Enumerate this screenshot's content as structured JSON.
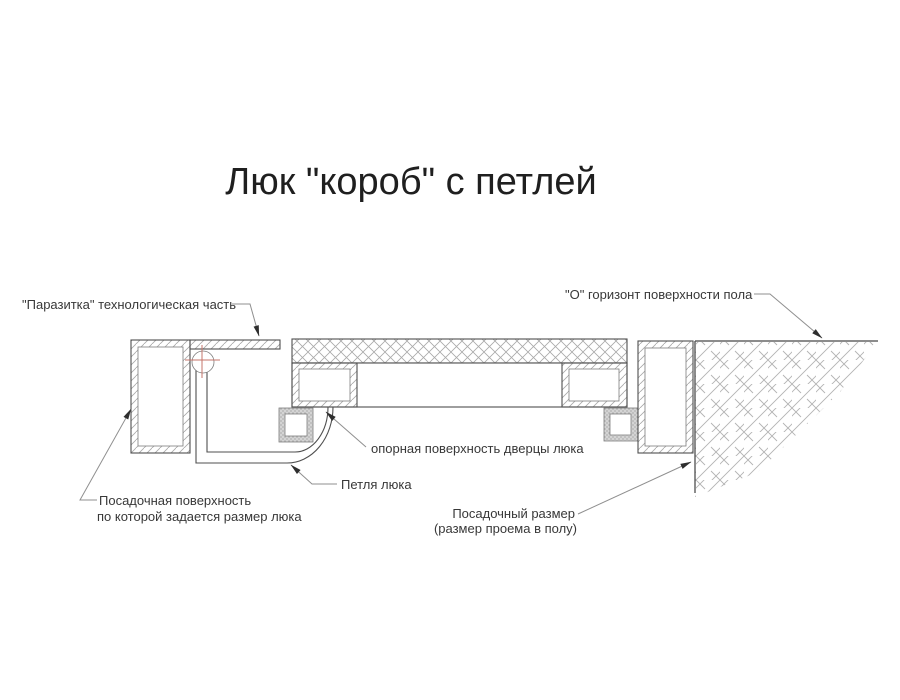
{
  "title": "Люк \"короб\" с петлей",
  "labels": {
    "parasitka": "\"Паразитка\" технологическая часть",
    "horizon": "\"О\" горизонт поверхности пола",
    "support_surface": "опорная поверхность дверцы люка",
    "hinge": "Петля люка",
    "seating_line1": "Посадочная поверхность",
    "seating_line2": "по которой задается размер люка",
    "opening_line1": "Посадочный размер",
    "opening_line2": "(размер проема в полу)"
  },
  "colors": {
    "line": "#4f4f4f",
    "line_light": "#7d7d7d",
    "hatch": "#a9a9a9",
    "hatch_floor": "#b3b3b3",
    "floor_line": "#8c8c8c",
    "leader": "#8f8f8f",
    "arrow": "#2e2e2e",
    "crosshair_red": "#c5756b",
    "text": "#383838",
    "title": "#1f1f1f",
    "seal_fill": "#d4d4d4",
    "seal_dot": "#8f8f8f",
    "bg": "#ffffff"
  }
}
